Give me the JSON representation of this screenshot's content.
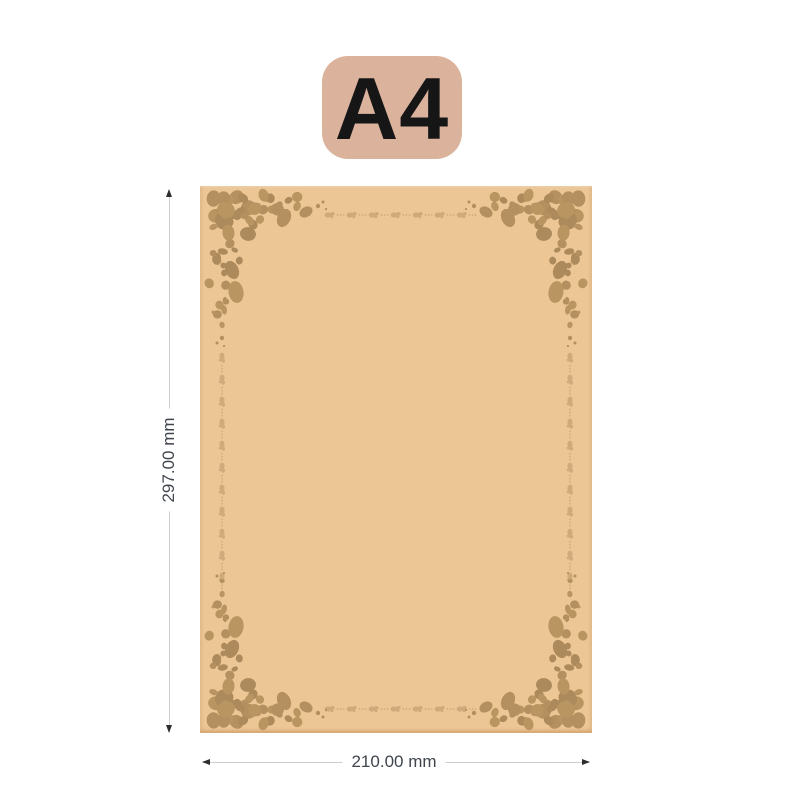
{
  "format_badge": {
    "label": "A4",
    "bg_color": "#dbb29c",
    "text_color": "#161616"
  },
  "paper": {
    "fill_color": "#edc696",
    "ornament_color": "#b18e5f"
  },
  "dimensions": {
    "height": "297.00 mm",
    "width": "210.00 mm"
  }
}
